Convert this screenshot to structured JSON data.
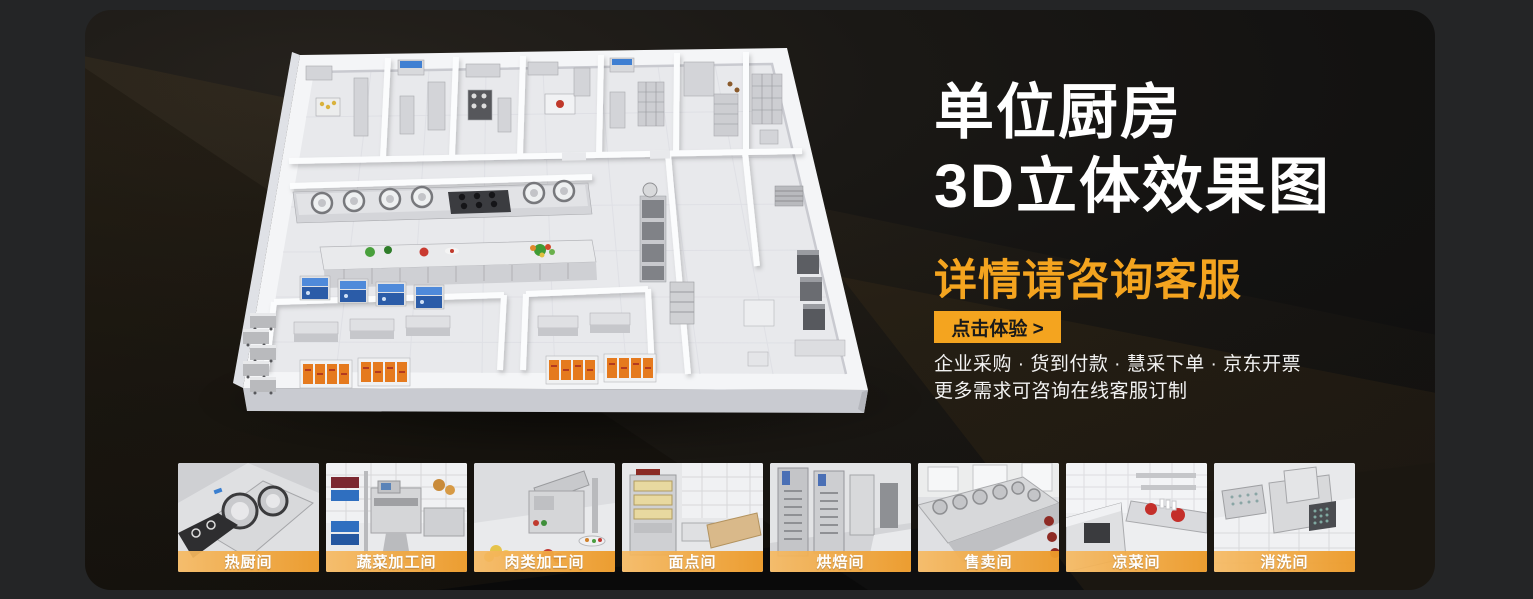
{
  "banner": {
    "title_line1": "单位厨房",
    "title_line2": "3D立体效果图",
    "subtitle": "详情请咨询客服",
    "cta_label": "点击体验 >",
    "info_line1": "企业采购 · 货到付款 · 慧采下单 · 京东开票",
    "info_line2": "更多需求可咨询在线客服订制"
  },
  "colors": {
    "accent": "#F4A41F",
    "title": "#FFFFFF",
    "band_start": "rgba(246,186,99,0.92)",
    "band_end": "rgba(236,154,41,0.96)"
  },
  "gallery": {
    "items": [
      {
        "label": "热厨间"
      },
      {
        "label": "蔬菜加工间"
      },
      {
        "label": "肉类加工间"
      },
      {
        "label": "面点间"
      },
      {
        "label": "烘焙间"
      },
      {
        "label": "售卖间"
      },
      {
        "label": "凉菜间"
      },
      {
        "label": "消洗间"
      }
    ]
  }
}
